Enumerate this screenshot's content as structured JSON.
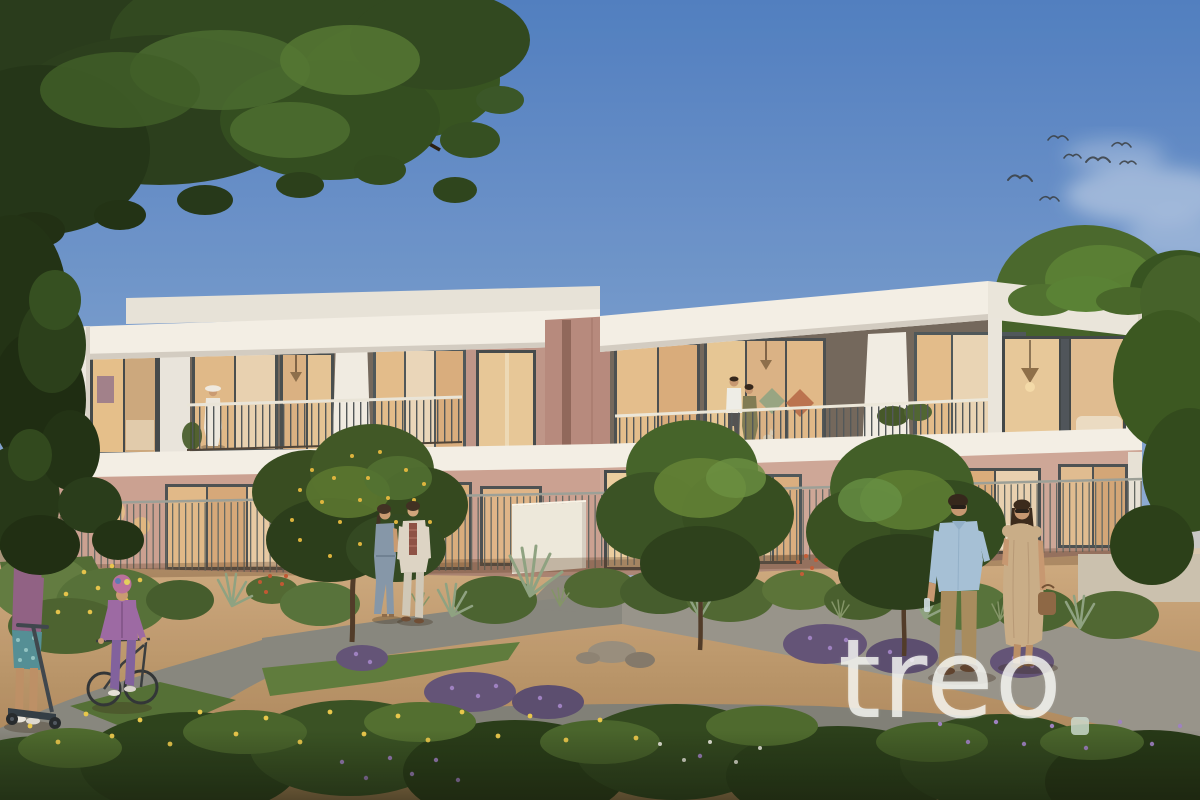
{
  "scene": {
    "type": "architectural exterior rendering",
    "description": "Modern two-storey terraced townhouses with warm lit interiors, balconies and a landscaped desert-style community garden at dusk; children playing and couples strolling on curved pathways; birds flying in a blue sky",
    "watermark": {
      "text": "treo",
      "dot": "."
    },
    "birds_count": 7,
    "figures": [
      "boy standing with scooter",
      "child riding bicycle with helmet",
      "couple walking on garden path",
      "woman in white with sun hat on left balcony",
      "couple standing on right balcony",
      "man in blue shirt walking",
      "woman in beige dress with handbag",
      "cat on balcony"
    ]
  },
  "palette": {
    "sky_top": "#4b7dc3",
    "sky_mid": "#7da2d4",
    "sky_horizon": "#bccee8",
    "facade_white": "#f3f1ea",
    "facade_shadow": "#d6d2c8",
    "facade_pink": "#c9a193",
    "facade_pink_warm": "#cda79a",
    "facade_pink_deep": "#b5897e",
    "window_glow": "#e4c08c",
    "window_glow_deep": "#d5a87a",
    "window_frame": "#474f53",
    "curtain": "#ead8bd",
    "railing": "#4d5559",
    "foliage_dark": "#24391a",
    "foliage_mid": "#3f5f28",
    "foliage_light": "#5d8034",
    "lawn": "#5d7d3e",
    "sand_light": "#cdab81",
    "sand_dark": "#a07c52",
    "path": "#84867f",
    "pavement": "#94938c",
    "flower_yellow": "#e8c84a",
    "flower_purple": "#9b7fc4",
    "watermark_color": "rgba(247,249,245,0.8)"
  }
}
